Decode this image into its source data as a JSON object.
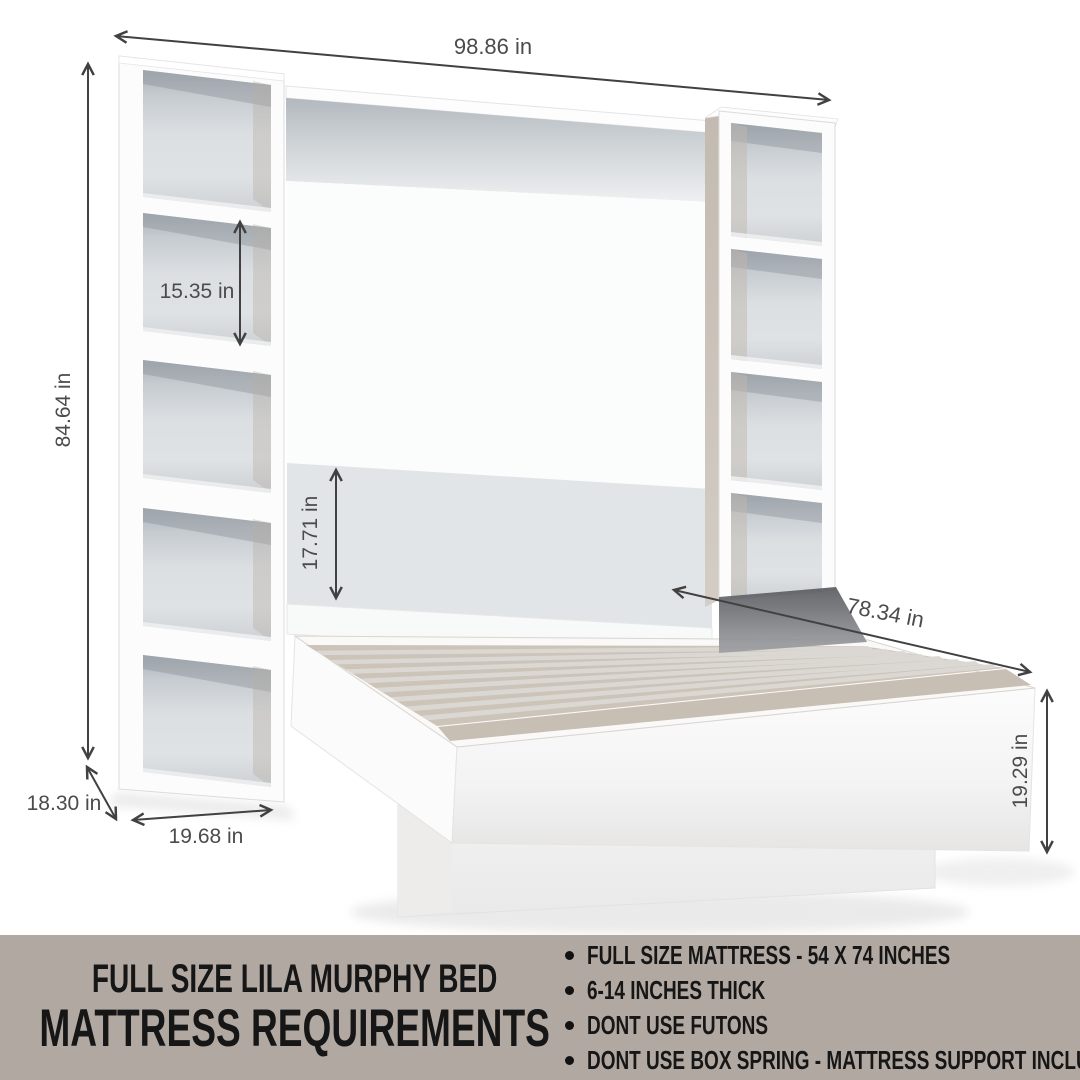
{
  "diagram": {
    "dim_overall_width": "98.86 in",
    "dim_overall_height": "84.64 in",
    "dim_shelf_opening": "15.35 in",
    "dim_panel_height": "17.71 in",
    "dim_bed_length": "78.34 in",
    "dim_bed_height": "19.29 in",
    "dim_side_depth": "18.30 in",
    "dim_side_width": "19.68 in",
    "colors": {
      "arrow": "#414141",
      "wood_accent": "#c7beb4",
      "panel_gray": "#e2e5e8"
    }
  },
  "banner": {
    "title_line1": "FULL SIZE LILA MURPHY BED",
    "title_line2": "MATTRESS REQUIREMENTS",
    "bullets": [
      "FULL SIZE MATTRESS - 54 X 74 INCHES",
      "6-14 INCHES THICK",
      "DONT USE FUTONS",
      "DONT USE BOX SPRING - MATTRESS SUPPORT INCLUDED"
    ],
    "colors": {
      "background": "#b1a8a1",
      "text": "#161616"
    }
  }
}
